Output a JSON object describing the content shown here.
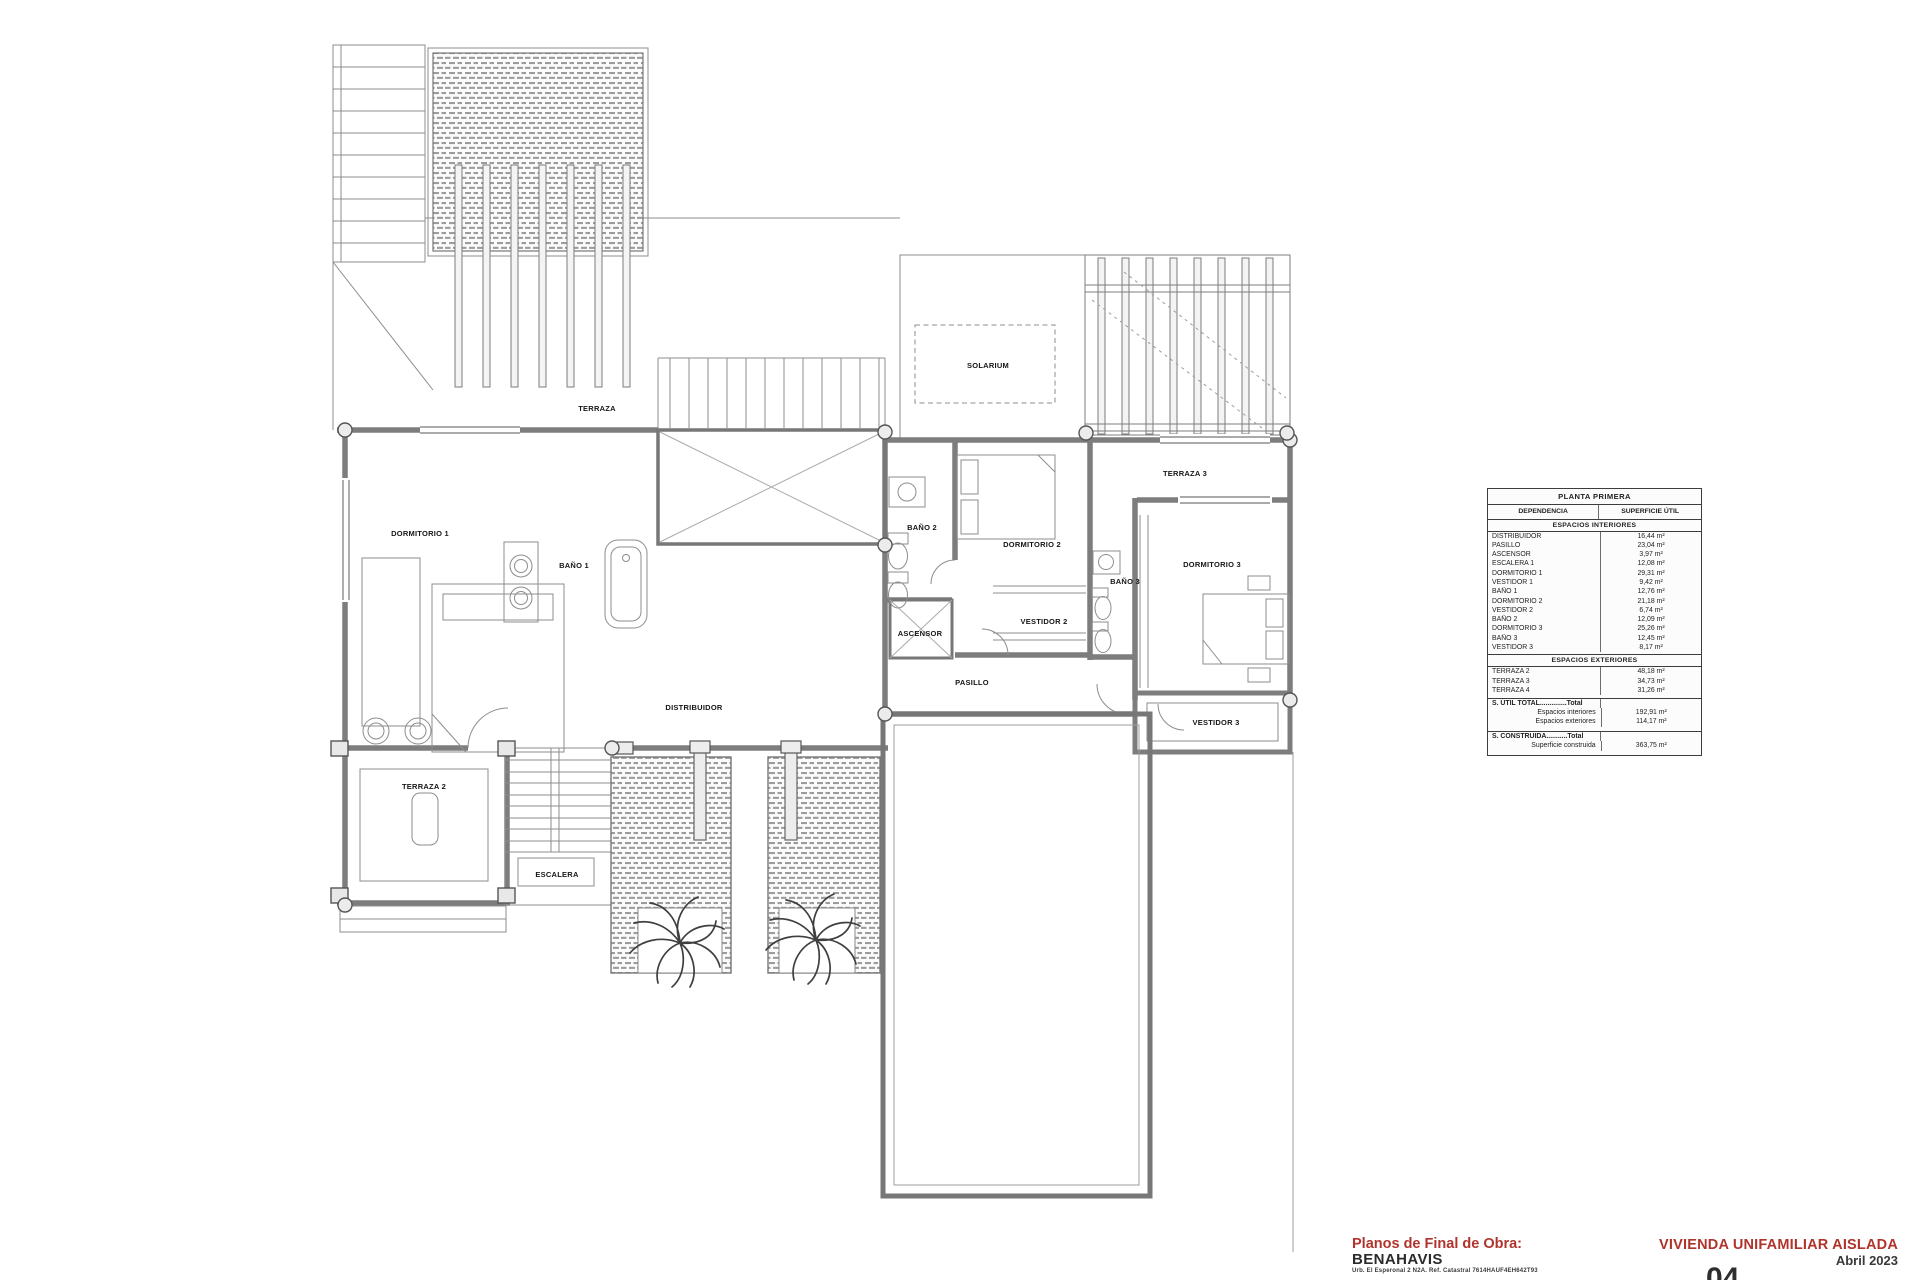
{
  "plan": {
    "labels": {
      "terraza": "TERRAZA",
      "solarium": "SOLARIUM",
      "dormitorio1": "DORMITORIO 1",
      "bano1": "BAÑO 1",
      "bano2": "BAÑO 2",
      "dormitorio2": "DORMITORIO 2",
      "vestidor2": "VESTIDOR 2",
      "bano3": "BAÑO 3",
      "terraza3": "TERRAZA 3",
      "dormitorio3": "DORMITORIO 3",
      "ascensor": "ASCENSOR",
      "distribuidor": "DISTRIBUIDOR",
      "pasillo": "PASILLO",
      "terraza2": "TERRAZA 2",
      "escalera": "ESCALERA",
      "vestidor3": "VESTIDOR 3"
    }
  },
  "table": {
    "title": "PLANTA PRIMERA",
    "col_dependencia": "DEPENDENCIA",
    "col_superficie": "SUPERFICIE ÚTIL",
    "section_interiores": "ESPACIOS INTERIORES",
    "interior_rows": [
      {
        "name": "DISTRIBUIDOR",
        "value": "16,44 m²"
      },
      {
        "name": "PASILLO",
        "value": "23,04 m²"
      },
      {
        "name": "ASCENSOR",
        "value": "3,97 m²"
      },
      {
        "name": "ESCALERA 1",
        "value": "12,08 m²"
      },
      {
        "name": "DORMITORIO 1",
        "value": "29,31 m²"
      },
      {
        "name": "VESTIDOR 1",
        "value": "9,42 m²"
      },
      {
        "name": "BAÑO 1",
        "value": "12,76 m²"
      },
      {
        "name": "DORMITORIO 2",
        "value": "21,18 m²"
      },
      {
        "name": "VESTIDOR 2",
        "value": "6,74 m²"
      },
      {
        "name": "BAÑO 2",
        "value": "12,09 m²"
      },
      {
        "name": "DORMITORIO 3",
        "value": "25,26 m²"
      },
      {
        "name": "BAÑO 3",
        "value": "12,45 m²"
      },
      {
        "name": "VESTIDOR 3",
        "value": "8,17 m²"
      }
    ],
    "section_exteriores": "ESPACIOS EXTERIORES",
    "exterior_rows": [
      {
        "name": "TERRAZA 2",
        "value": "48,18 m²"
      },
      {
        "name": "TERRAZA 3",
        "value": "34,73 m²"
      },
      {
        "name": "TERRAZA 4",
        "value": "31,26 m²"
      }
    ],
    "totals_util": {
      "heading": "S. ÚTIL TOTAL..............Total",
      "rows": [
        {
          "name": "Espacios interiores",
          "value": "192,91 m²"
        },
        {
          "name": "Espacios exteriores",
          "value": "114,17 m²"
        }
      ]
    },
    "totals_construida": {
      "heading": "S. CONSTRUIDA...........Total",
      "rows": [
        {
          "name": "Superficie construida",
          "value": "363,75 m²"
        }
      ]
    }
  },
  "titleblock": {
    "doc_type": "Planos de Final de Obra:",
    "municipality": "BENAHAVIS",
    "address_line": "Urb. El Esperonal 2 N2A. Ref. Catastral 7614HAUF4EH642T93",
    "project": "VIVIENDA UNIFAMILIAR AISLADA",
    "date": "Abril 2023",
    "sheet": "04",
    "accent_color": "#b0342c"
  }
}
